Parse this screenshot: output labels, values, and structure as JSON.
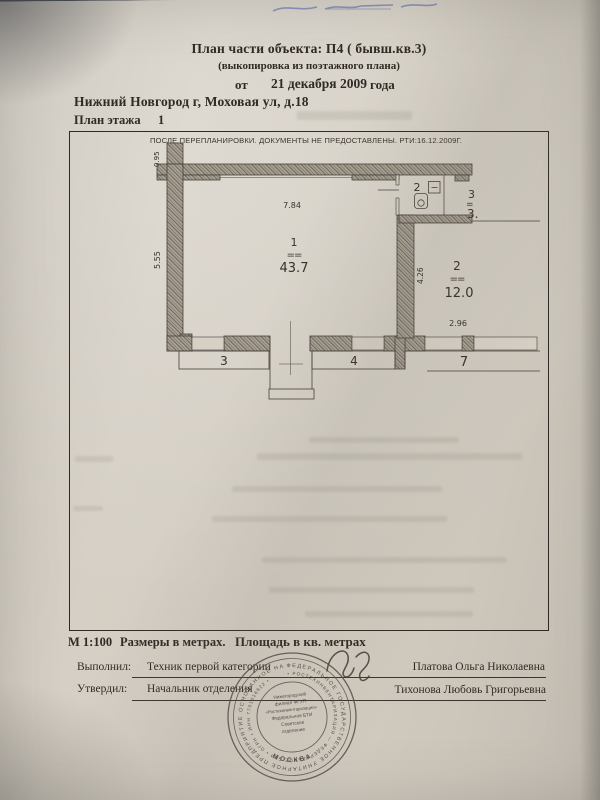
{
  "colors": {
    "paper": "#d3ccc1",
    "ink": "#2f2a23",
    "plan_line": "#44403a",
    "stamp_ink": "#4d483f",
    "handwriting_blue": "#4c5da8"
  },
  "header": {
    "title_line1": "План части объекта:  П4 ( бывш.кв.3)",
    "title_line2": "(выкопировка  из поэтажного плана)",
    "date_prefix": "от",
    "date_value": "21 декабря 2009",
    "date_suffix": "года",
    "address": "Нижний Новгород г, Моховая ул, д.18",
    "floor_label": "План этажа",
    "floor_value": "1"
  },
  "plan": {
    "banner": "ПОСЛЕ ПЕРЕПЛАНИРОВКИ. ДОКУМЕНТЫ НЕ ПРЕДОСТАВЛЕНЫ. РТИ:16.12.2009Г.",
    "dims": {
      "stub": "0.95",
      "top": "7.84",
      "left": "5.55",
      "middle": "4.26",
      "right": "2.96"
    },
    "room1": {
      "number": "1",
      "tie": "==",
      "area": "43.7"
    },
    "room2": {
      "number": "2",
      "tie": "==",
      "area": "12.0"
    },
    "wc": {
      "number": "2"
    },
    "room3": {
      "number": "3",
      "tie": "=",
      "area": "3."
    },
    "porches": {
      "p3": "3",
      "p4": "4",
      "p7": "7"
    }
  },
  "footer": {
    "scale": "М 1:100",
    "units_dims": "Размеры в метрах.",
    "units_area": "Площадь в кв. метрах",
    "executed_label": "Выполнил:",
    "executed_role": "Техник первой категории",
    "executed_name": "Платова Ольга Николаевна",
    "approved_label": "Утвердил:",
    "approved_role": "Начальник отделения",
    "approved_name": "Тихонова Любовь Григорьевна"
  },
  "stamp": {
    "ring_outer": "ФЕДЕРАЛЬНОЕ ГОСУДАРСТВЕННОЕ УНИТАРНОЕ ПРЕДПРИЯТИЕ ОСНОВАННОЕ НА ПРАВЕ ХОЗЯЙСТВЕННОГО ВЕДЕНИЯ",
    "ring_inner": "• РОСТЕХИНВЕНТАРИЗАЦИЯ — ФЕДЕРАЛЬНОЕ БТИ • ОГРН • ИНН 7701016822 •",
    "city": "МОСКВА",
    "center_line1": "Нижегородский",
    "center_line2": "филиал ФГУП",
    "center_line3": "«Ростехинвентаризация»",
    "center_line4": "Федеральное БТИ",
    "center_line5": "Советское",
    "center_line6": "отделение"
  }
}
